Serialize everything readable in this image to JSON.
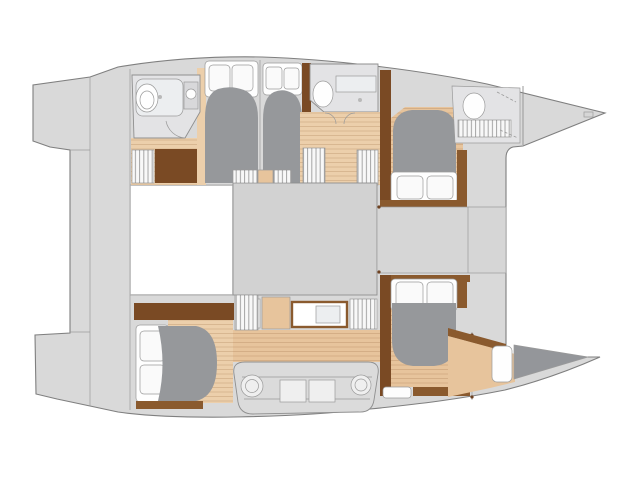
{
  "meta": {
    "title": "Catamaran yacht accommodation floor plan",
    "view": "top-down deck plan, bow pointing right",
    "diagram_type": "boat-floor-plan",
    "visible_text": []
  },
  "colors": {
    "background": "#ffffff",
    "deck": "#d9d9d9",
    "deck_band": "#d6d6d6",
    "saloon": "#d2d2d2",
    "gangway": "#d6d6d6",
    "outline": "#8f8f8f",
    "wood": "#eccfab",
    "wood_warm": "#e7c49c",
    "trim": "#7a4a24",
    "trim_light": "#8a5a2e",
    "duvet": "#96989b",
    "dark_pad": "#94969a",
    "mattress": "#fefefe",
    "pillow": "#fafafa",
    "room": "#e3e3e5",
    "fixture": "#eceef0",
    "sink": "#d8d8da",
    "hatch_bg": "#f8f8f8",
    "settee": "#dbdbdb",
    "table": "#efefef",
    "window": "#fdfdfd"
  },
  "areas": [
    {
      "id": "transom-steps",
      "role": "stern swim steps"
    },
    {
      "id": "aft-deck",
      "role": "aft deck"
    },
    {
      "id": "top-hull-aft-head",
      "role": "bathroom with shower, toilet, washbasin"
    },
    {
      "id": "top-hull-companionway",
      "role": "stairs and cabinet"
    },
    {
      "id": "top-hull-aft-cabin-1",
      "role": "double berth cabin"
    },
    {
      "id": "top-hull-aft-cabin-2",
      "role": "double berth cabin"
    },
    {
      "id": "top-hull-fwd-head",
      "role": "bathroom"
    },
    {
      "id": "top-hull-fwd-cabin",
      "role": "double berth cabin"
    },
    {
      "id": "forepeak-head",
      "role": "forepeak toilet compartment"
    },
    {
      "id": "saloon",
      "role": "central saloon"
    },
    {
      "id": "galley",
      "role": "galley cabinets and sink"
    },
    {
      "id": "settee",
      "role": "settee with tables"
    },
    {
      "id": "bottom-hull-aft-cabin",
      "role": "double berth cabin"
    },
    {
      "id": "bottom-hull-fwd-cabin",
      "role": "double berth cabin"
    },
    {
      "id": "forepeak-berth",
      "role": "forepeak crew berth"
    }
  ]
}
